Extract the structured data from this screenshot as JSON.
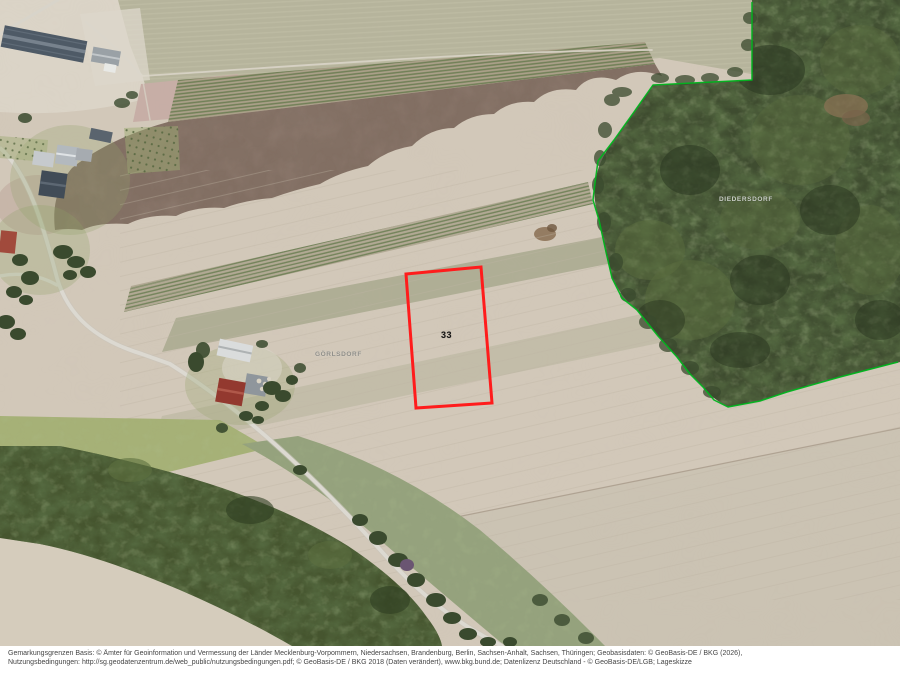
{
  "map": {
    "parcel": {
      "number": "33",
      "stroke_color": "#ff1c1c"
    },
    "places": {
      "left": "GÖRLSDORF",
      "right": "DIEDERSDORF"
    },
    "district_boundary_color": "#00b41e"
  },
  "footer": {
    "line1": "Gemarkungsgrenzen Basis: © Ämter für Geoinformation und Vermessung der Länder Mecklenburg-Vorpommern, Niedersachsen, Brandenburg, Berlin, Sachsen-Anhalt, Sachsen, Thüringen; Geobasisdaten: © GeoBasis-DE / BKG (2026),",
    "line2": "Nutzungsbedingungen: http://sg.geodatenzentrum.de/web_public/nutzungsbedingungen.pdf; © GeoBasis-DE / BKG 2018 (Daten verändert), www.bkg.bund.de; Datenlizenz Deutschland - © GeoBasis-DE/LGB; Lageskizze"
  }
}
